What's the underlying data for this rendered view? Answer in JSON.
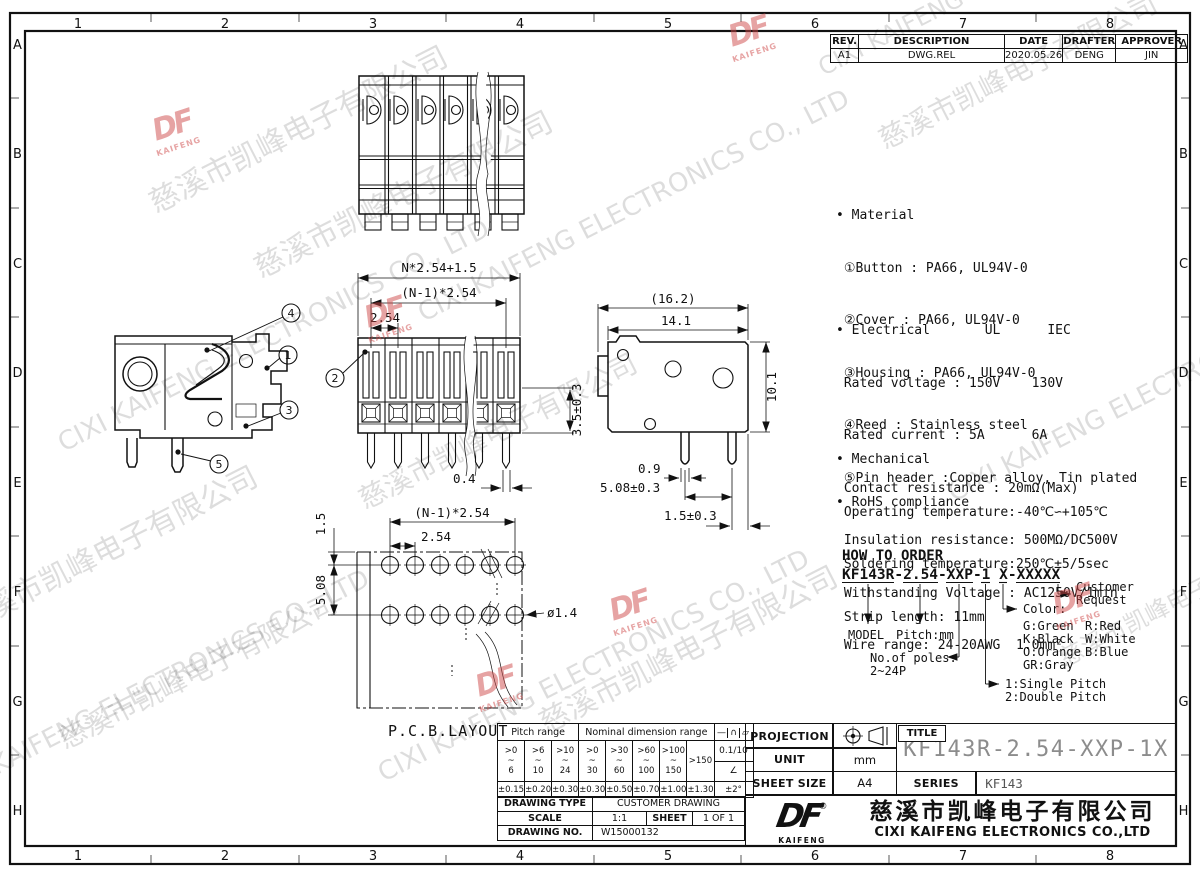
{
  "grid": {
    "cols": [
      "1",
      "2",
      "3",
      "4",
      "5",
      "6",
      "7",
      "8"
    ],
    "rows": [
      "A",
      "B",
      "C",
      "D",
      "E",
      "F",
      "G",
      "H"
    ]
  },
  "revision": {
    "headers": [
      "REV.",
      "DESCRIPTION",
      "DATE",
      "DRAFTER",
      "APPROVER"
    ],
    "row": [
      "A1",
      "DWG.REL",
      "2020.05.26",
      "DENG",
      "JIN"
    ]
  },
  "notes": {
    "material": [
      "• Material",
      " ①Button : PA66, UL94V-0",
      " ②Cover : PA66, UL94V-0",
      " ③Housing : PA66, UL94V-0",
      " ④Reed : Stainless steel",
      " ⑤Pin header :Copper alloy, Tin plated"
    ],
    "electrical": [
      "• Electrical       UL      IEC",
      " Rated voltage : 150V    130V",
      " Rated current : 5A      6A",
      " Contact resistance : 20mΩ(Max)",
      " Insulation resistance: 500MΩ/DC500V",
      " Withstanding Voltage : AC1250V/1min",
      " Wire range: 24-20AWG  1.0mm²"
    ],
    "mechanical": [
      "• Mechanical",
      " Operating temperature:-40℃∽+105℃",
      " Soldering temperature:250℃±5/5sec",
      " Strip length: 11mm"
    ],
    "rohs": "• RoHS compliance"
  },
  "order": {
    "title": "HOW TO ORDER",
    "code": "KF143R-2.54-XXP-1 X-XXXXX",
    "model_label": "MODEL",
    "pitch_label": "Pitch:mm",
    "poles_label1": "No.of poles:",
    "poles_label2": "2~24P",
    "pitch_type1": "1:Single Pitch",
    "pitch_type2": "2:Double Pitch",
    "color_label": "Color:",
    "colors_left": [
      "G:Green",
      "K:Black",
      "O:Orange",
      "GR:Gray"
    ],
    "colors_right": [
      "R:Red",
      "W:White",
      "B:Blue"
    ],
    "customer1": "Customer",
    "customer2": "Request"
  },
  "dims": {
    "front_total": "N*2.54+1.5",
    "front_span": "(N-1)*2.54",
    "front_pitch": "2.54",
    "front_height": "3.5±0.3",
    "front_pin": "0.4",
    "side_overall": "(16.2)",
    "side_body": "14.1",
    "side_height": "10.1",
    "side_pin_w": "0.9",
    "side_pin_pitch": "5.08±0.3",
    "side_pin_edge": "1.5±0.3",
    "pcb_edge": "1.5",
    "pcb_span": "(N-1)*2.54",
    "pcb_pitch": "2.54",
    "pcb_row": "5.08",
    "pcb_hole": "ø1.4",
    "pcb_label": "P.C.B.LAYOUT"
  },
  "callouts": [
    "1",
    "2",
    "3",
    "4",
    "5"
  ],
  "tolerance_table": {
    "pitch_header": "Pitch range",
    "nominal_header": "Nominal dimension range",
    "symbols": [
      "—",
      "∩",
      "▱"
    ],
    "ranges": [
      ">0\n~\n6",
      ">6\n~\n10",
      ">10\n~\n24",
      ">0\n~\n30",
      ">30\n~\n60",
      ">60\n~\n100",
      ">100\n~\n150",
      ">150"
    ],
    "flatness": "0.1/10",
    "angle_symbol": "∠",
    "values": [
      "±0.15",
      "±0.20",
      "±0.30",
      "±0.30",
      "±0.50",
      "±0.70",
      "±1.00",
      "±1.30",
      "±2°"
    ]
  },
  "drawing_info": {
    "type_label": "DRAWING TYPE",
    "type_value": "CUSTOMER DRAWING",
    "scale_label": "SCALE",
    "scale_value": "1:1",
    "sheet_label": "SHEET",
    "sheet_value": "1 OF 1",
    "no_label": "DRAWING NO.",
    "no_value": "W15000132"
  },
  "title_block": {
    "projection_label": "PROJECTION",
    "unit_label": "UNIT",
    "unit_value": "mm",
    "sheet_size_label": "SHEET SIZE",
    "sheet_size_value": "A4",
    "title_label": "TITLE",
    "title_value": "KF143R-2.54-XXP-1X",
    "series_label": "SERIES",
    "series_value": "KF143"
  },
  "company": {
    "logo": "DF",
    "logo_sub": "KAIFENG",
    "registered": "®",
    "name_cn": "慈溪市凯峰电子有限公司",
    "name_en": "CIXI KAIFENG ELECTRONICS CO.,LTD"
  },
  "watermark": {
    "cn": "慈溪市凯峰电子有限公司",
    "en": "CIXI KAIFENG ELECTRONICS CO., LTD",
    "logo": "DF",
    "logo_sub": "KAIFENG"
  },
  "colors": {
    "line": "#111111",
    "title_gray": "#8c8c8c",
    "watermark_red": "#cf4a4a",
    "paper": "#ffffff"
  }
}
